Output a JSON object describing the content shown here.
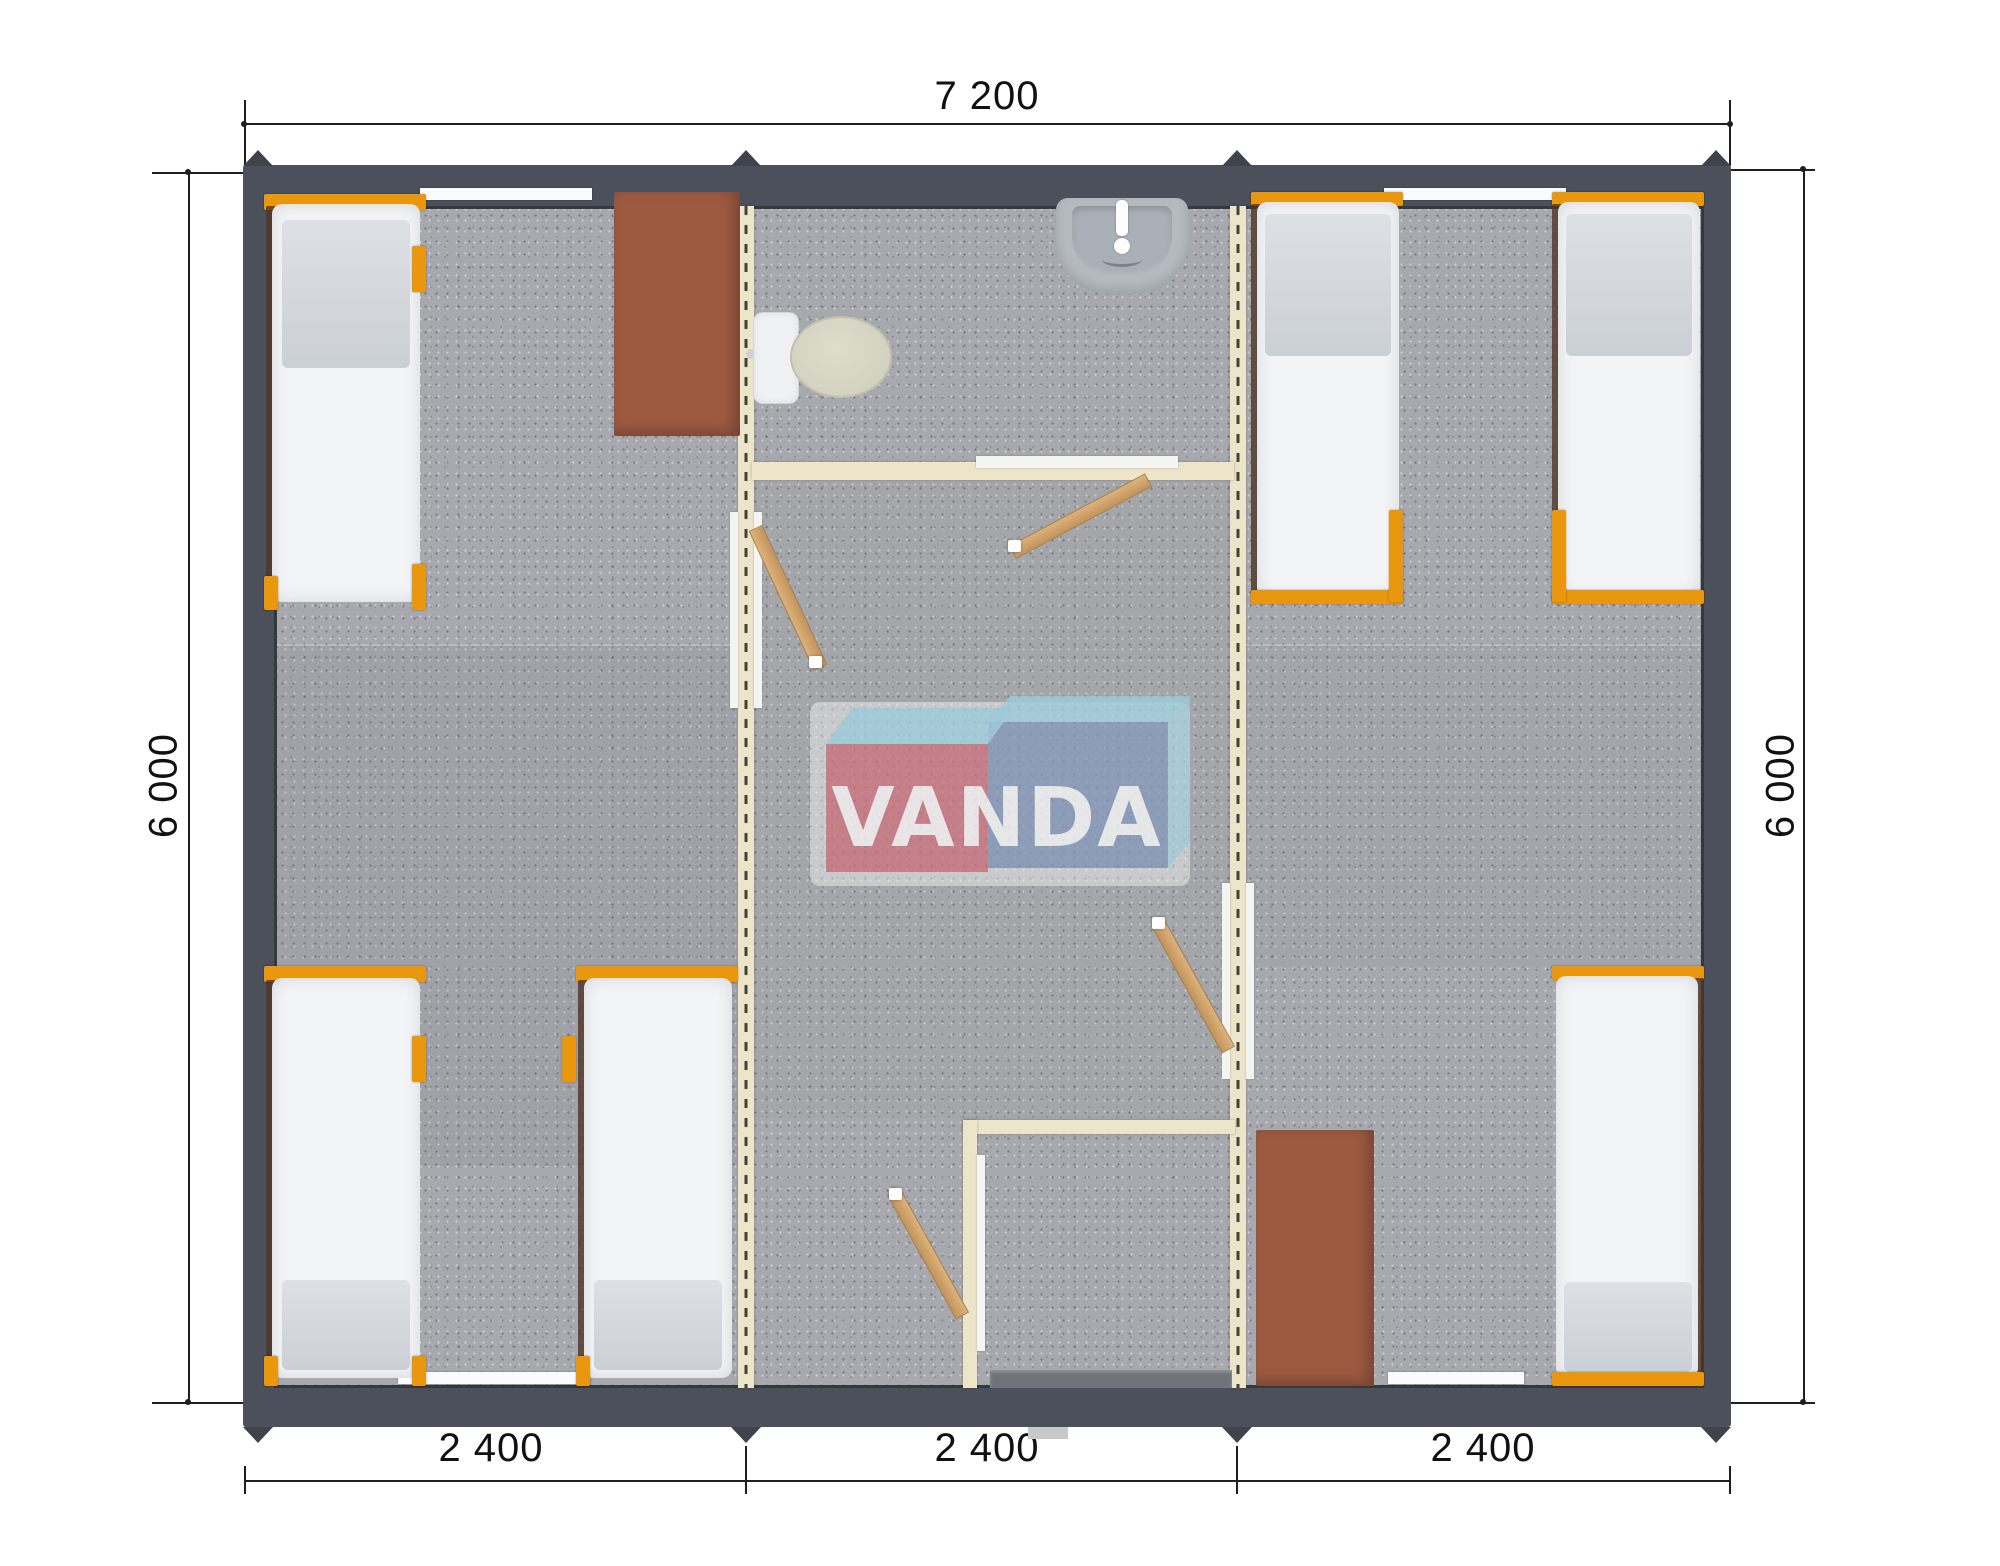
{
  "meta": {
    "description": "Top-view floor plan rendering of a 7200 x 6000 modular cabin with three 2400 modules: left bedroom (3 beds, desk), central corridor with bathroom (toilet, sink) and shower room, right bedroom (3 beds, desk)"
  },
  "dimensions": {
    "top": "7 200",
    "left": "6 000",
    "right": "6 000",
    "bottom": [
      "2 400",
      "2 400",
      "2 400"
    ]
  },
  "logo": {
    "text": "VANDA"
  },
  "colors": {
    "ink": "#1f1f1f",
    "wall": "#4c505a",
    "wall-edge": "#35383f",
    "floor": "#a8a9ae",
    "cream": "#ece5c9",
    "dash": "#45423a",
    "orange": "#e9970f",
    "mattress": "#f3f4f6",
    "pillow": "#d6dade",
    "table": "#9d5a41",
    "wood": "#d2a469",
    "fixture": "#b4bac0",
    "logo-red": "#cb5e6c",
    "logo-blue": "#7a91b7",
    "logo-cyan": "#9ed2e4"
  }
}
